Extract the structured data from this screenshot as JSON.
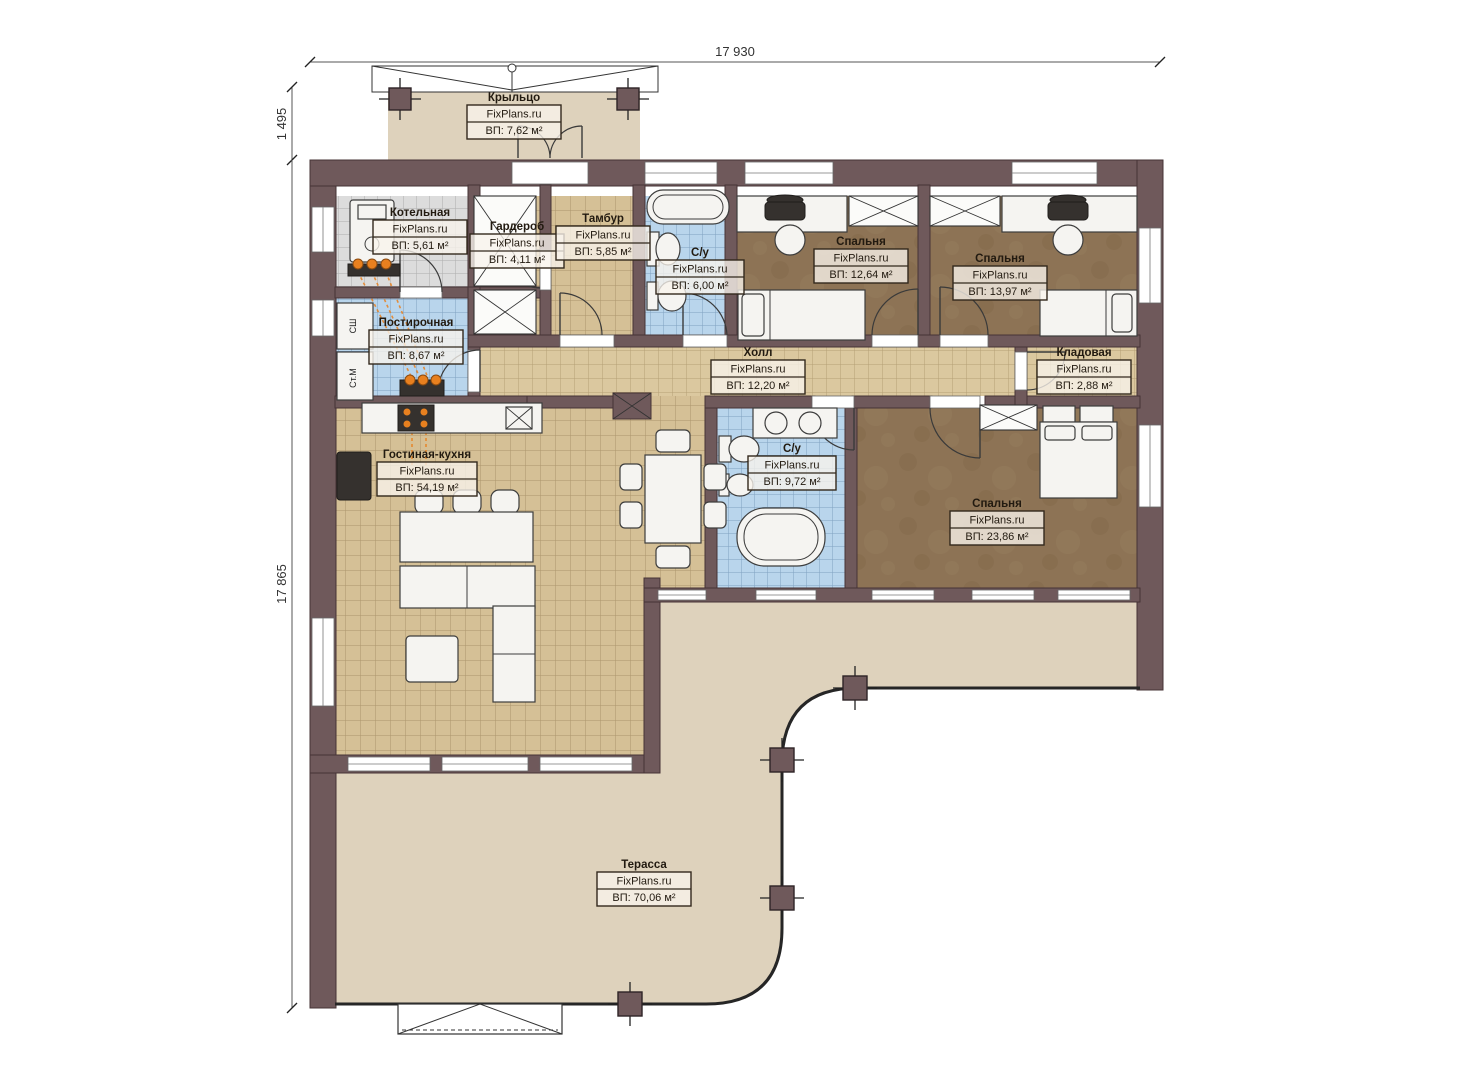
{
  "dimensions": {
    "width_top": "17 930",
    "height_left_upper": "1 495",
    "height_left_lower": "17 865"
  },
  "watermark": "FixPlans.ru",
  "rooms": [
    {
      "name": "Крыльцо",
      "area": "ВП: 7,62 м²"
    },
    {
      "name": "Котельная",
      "area": "ВП: 5,61 м²"
    },
    {
      "name": "Гардероб",
      "area": "ВП: 4,11 м²"
    },
    {
      "name": "Тамбур",
      "area": "ВП: 5,85 м²"
    },
    {
      "name": "С/у",
      "area": "ВП: 6,00 м²"
    },
    {
      "name": "Спальня",
      "area": "ВП: 12,64 м²"
    },
    {
      "name": "Спальня",
      "area": "ВП: 13,97 м²"
    },
    {
      "name": "Постирочная",
      "area": "ВП: 8,67 м²"
    },
    {
      "name": "Холл",
      "area": "ВП: 12,20 м²"
    },
    {
      "name": "Кладовая",
      "area": "ВП: 2,88 м²"
    },
    {
      "name": "Гостиная-кухня",
      "area": "ВП: 54,19 м²"
    },
    {
      "name": "С/у",
      "area": "ВП: 9,72 м²"
    },
    {
      "name": "Спальня",
      "area": "ВП: 23,86 м²"
    },
    {
      "name": "Терасса",
      "area": "ВП: 70,06 м²"
    }
  ],
  "appliances": {
    "dryer": "СШ",
    "washer": "Ст.М"
  },
  "colors": {
    "wall": "#6f595b",
    "terrace": "#ded2bc",
    "floor_tan": "#d5c096",
    "floor_blue": "#b9d5ec",
    "floor_gray": "#dcdcdc",
    "floor_bedroom": "#8d7355",
    "heating_pipe": "#e8801f"
  }
}
